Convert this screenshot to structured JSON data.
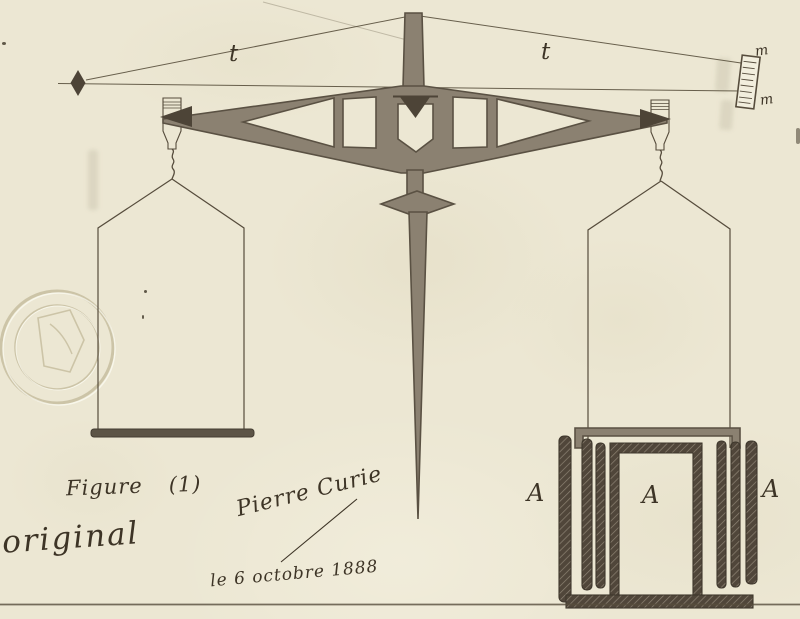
{
  "labels": {
    "thread_left": "t",
    "thread_right": "t",
    "scale_top": "m",
    "scale_bottom": "m",
    "vessel_left": "A",
    "vessel_center": "A",
    "vessel_right": "A"
  },
  "captions": {
    "figure_word": "Figure",
    "figure_number": "(1)",
    "original": "original",
    "signature": "Pierre Curie",
    "date": "le 6 octobre 1888"
  },
  "colors": {
    "paper": "#ece7d3",
    "ink": "#564c3c",
    "ink-dark": "#3d3426",
    "wash": "#8b8171",
    "wash-edge": "#5a5143",
    "dark-fill": "#4d4437",
    "hatch-dark": "#50463a",
    "seal": "#b3a883"
  }
}
